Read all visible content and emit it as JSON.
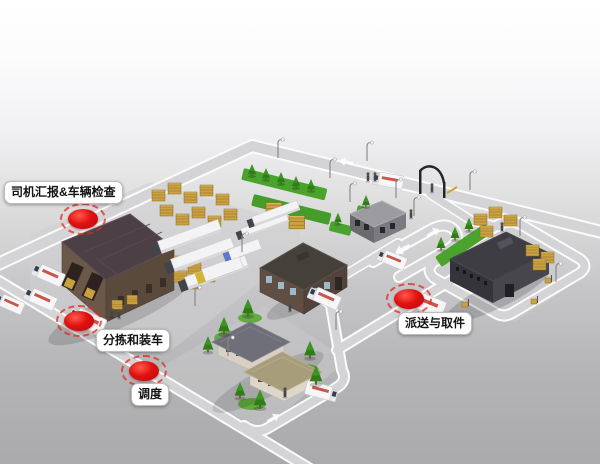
{
  "annotations": {
    "driver_report": {
      "label": "司机汇报&车辆检查"
    },
    "sorting_loading": {
      "label": "分拣和装车"
    },
    "dispatch": {
      "label": "调度"
    },
    "delivery_pickup": {
      "label": "派送与取件"
    }
  },
  "colors": {
    "marker_red": "#d41414",
    "label_background": "#ffffff",
    "label_text": "#141414",
    "road": "#d4d4d7",
    "road_edge": "#fbfbfc",
    "grass": "#4aa32c",
    "warehouse_roof": "#4c3f45",
    "warehouse_wall": "#6b5848",
    "office_wall": "#5f4e41",
    "dark_building": "#3e3d43",
    "gatehouse_roof": "#9b9ba0",
    "house_roof_gray": "#6f6f7a",
    "house_roof_tan": "#a89d7b",
    "pallet_gold": "#caa143",
    "truck_white": "#f6f6f8",
    "truck_logo_red": "#c0392b"
  },
  "scene": {
    "description": "Isometric 3D logistics depot with warehouse, trucks, gatehouse, houses and delivery routes",
    "elements": [
      "sorting-warehouse",
      "semi-trailer-trucks",
      "pallet-stacks",
      "delivery-vans",
      "office-building",
      "gatehouse",
      "security-gate",
      "dark-distribution-building",
      "residential-houses",
      "delivery-trucks",
      "trees",
      "street-lamps",
      "workers",
      "road-network"
    ]
  }
}
